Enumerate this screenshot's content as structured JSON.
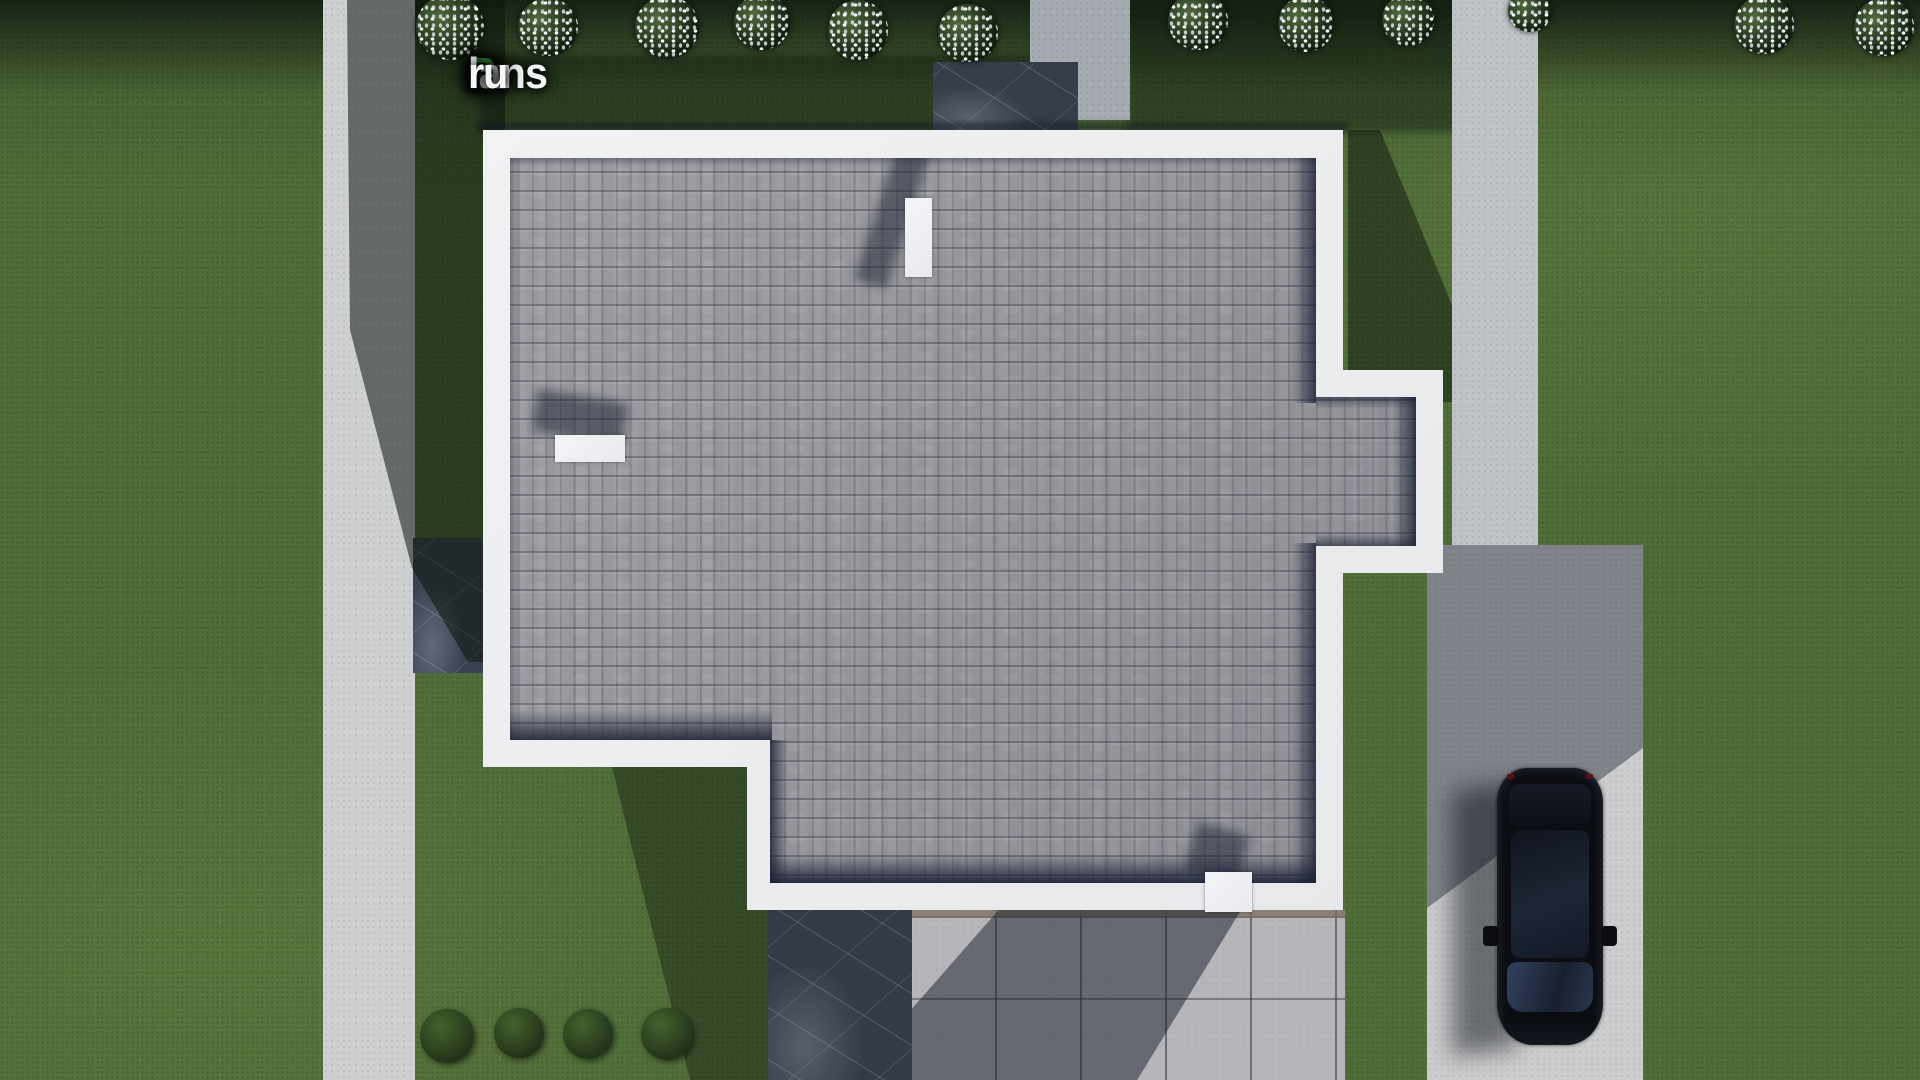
{
  "brand": {
    "name": "FixPlans.ru",
    "segments": [
      {
        "text": "F",
        "color": "#2e7fe8"
      },
      {
        "text": "ix",
        "color": "#f4f6f8"
      },
      {
        "text": "P",
        "color": "#41b649"
      },
      {
        "text": "lans",
        "color": "#f4f6f8"
      },
      {
        "text": ".",
        "color": "#2e7fe8"
      },
      {
        "text": "ru",
        "color": "#f4f6f8"
      }
    ]
  },
  "palette": {
    "grass_lit": "#4f6d38",
    "grass_dark": "#22371e",
    "concrete": "#c9cacc",
    "concrete_shadow": "#7b8195",
    "fascia_white": "#f2f2f3",
    "shingle": "#97979d",
    "shadow_navy": "#1c2236",
    "marble_dark": "#3a4150",
    "tile_light": "#b6b6ba",
    "car_black": "#0b0d12",
    "logo_blue": "#2e7fe8",
    "logo_green": "#41b649"
  },
  "scene": {
    "type": "aerial-3d-render-of-house-roof-plan",
    "house_roof": "gray-asphalt-shingles-with-white-fascia-border",
    "chimney_count": 3,
    "flowering_bush_count": 12,
    "green_bush_count": 4,
    "vehicle": "black-suv-parked-on-driveway",
    "hardscape": [
      "left-sidewalk",
      "right-road",
      "driveway-pad",
      "rear-walkway",
      "stone-patios",
      "tiled-terrace"
    ]
  }
}
